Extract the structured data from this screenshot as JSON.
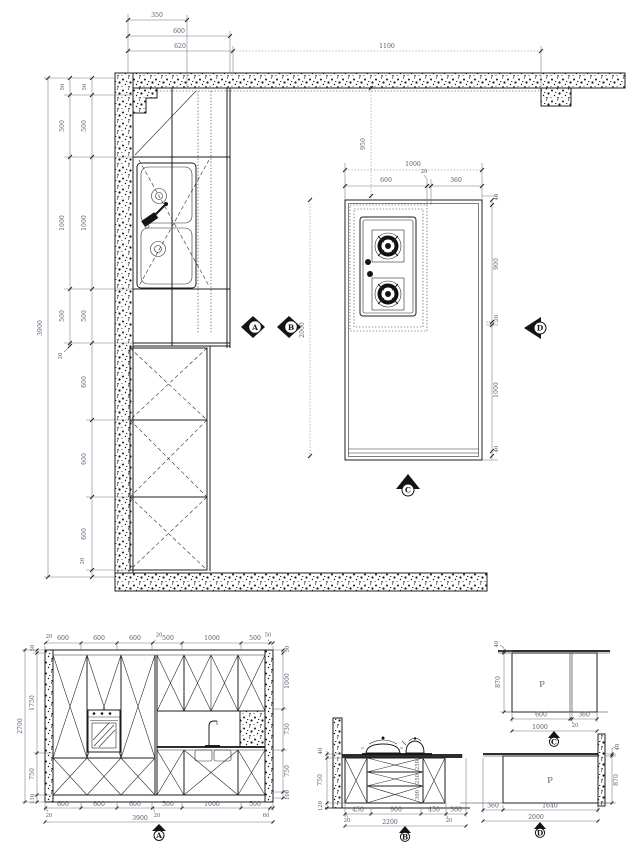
{
  "plan": {
    "top_dims": [
      "350",
      "600",
      "620",
      "1100"
    ],
    "left_total": "3900",
    "chain_mid": [
      "50",
      "500",
      "1000",
      "500",
      "20"
    ],
    "chain_inner": [
      "50",
      "500",
      "1000",
      "500",
      "600",
      "600",
      "600",
      "20"
    ],
    "island": {
      "offset_dim": "950",
      "width_total": "1000",
      "width_segs": [
        "600",
        "20",
        "360"
      ],
      "length_dim": "2000",
      "right_chain": [
        "40",
        "900",
        "20",
        "1000",
        "40"
      ]
    },
    "markers": {
      "a": "A",
      "b": "B",
      "c": "C",
      "d": "D"
    }
  },
  "elev_a": {
    "top_dims": [
      "20",
      "600",
      "600",
      "600",
      "20",
      "500",
      "1000",
      "500",
      "50"
    ],
    "bottom_dims": [
      "600",
      "600",
      "600",
      "500",
      "1000",
      "500"
    ],
    "bottom_ticks": [
      "20",
      "20",
      "60"
    ],
    "bottom_total": "3900",
    "left_chain": [
      "50",
      "1750",
      "750",
      "130"
    ],
    "left_total": "2700",
    "right_chain": [
      "50",
      "1000",
      "730",
      "750",
      "100"
    ],
    "marker": "A"
  },
  "elev_b": {
    "left_chain": [
      "40",
      "750",
      "120"
    ],
    "drawer_dims": [
      "250",
      "250",
      "300"
    ],
    "bottom_dims": [
      "450",
      "900",
      "450",
      "360"
    ],
    "bottom_ticks": [
      "20",
      "20"
    ],
    "bottom_total": "2200",
    "marker": "B"
  },
  "elev_c": {
    "panel_label": "P",
    "left_chain": [
      "40",
      "870"
    ],
    "bottom_dims": [
      "600",
      "360"
    ],
    "bottom_tick": "20",
    "bottom_total": "1000",
    "marker": "C"
  },
  "elev_d": {
    "panel_label": "P",
    "right_chain": [
      "40",
      "870"
    ],
    "bottom_dims": [
      "360",
      "1640"
    ],
    "bottom_total": "2000",
    "marker": "D"
  }
}
